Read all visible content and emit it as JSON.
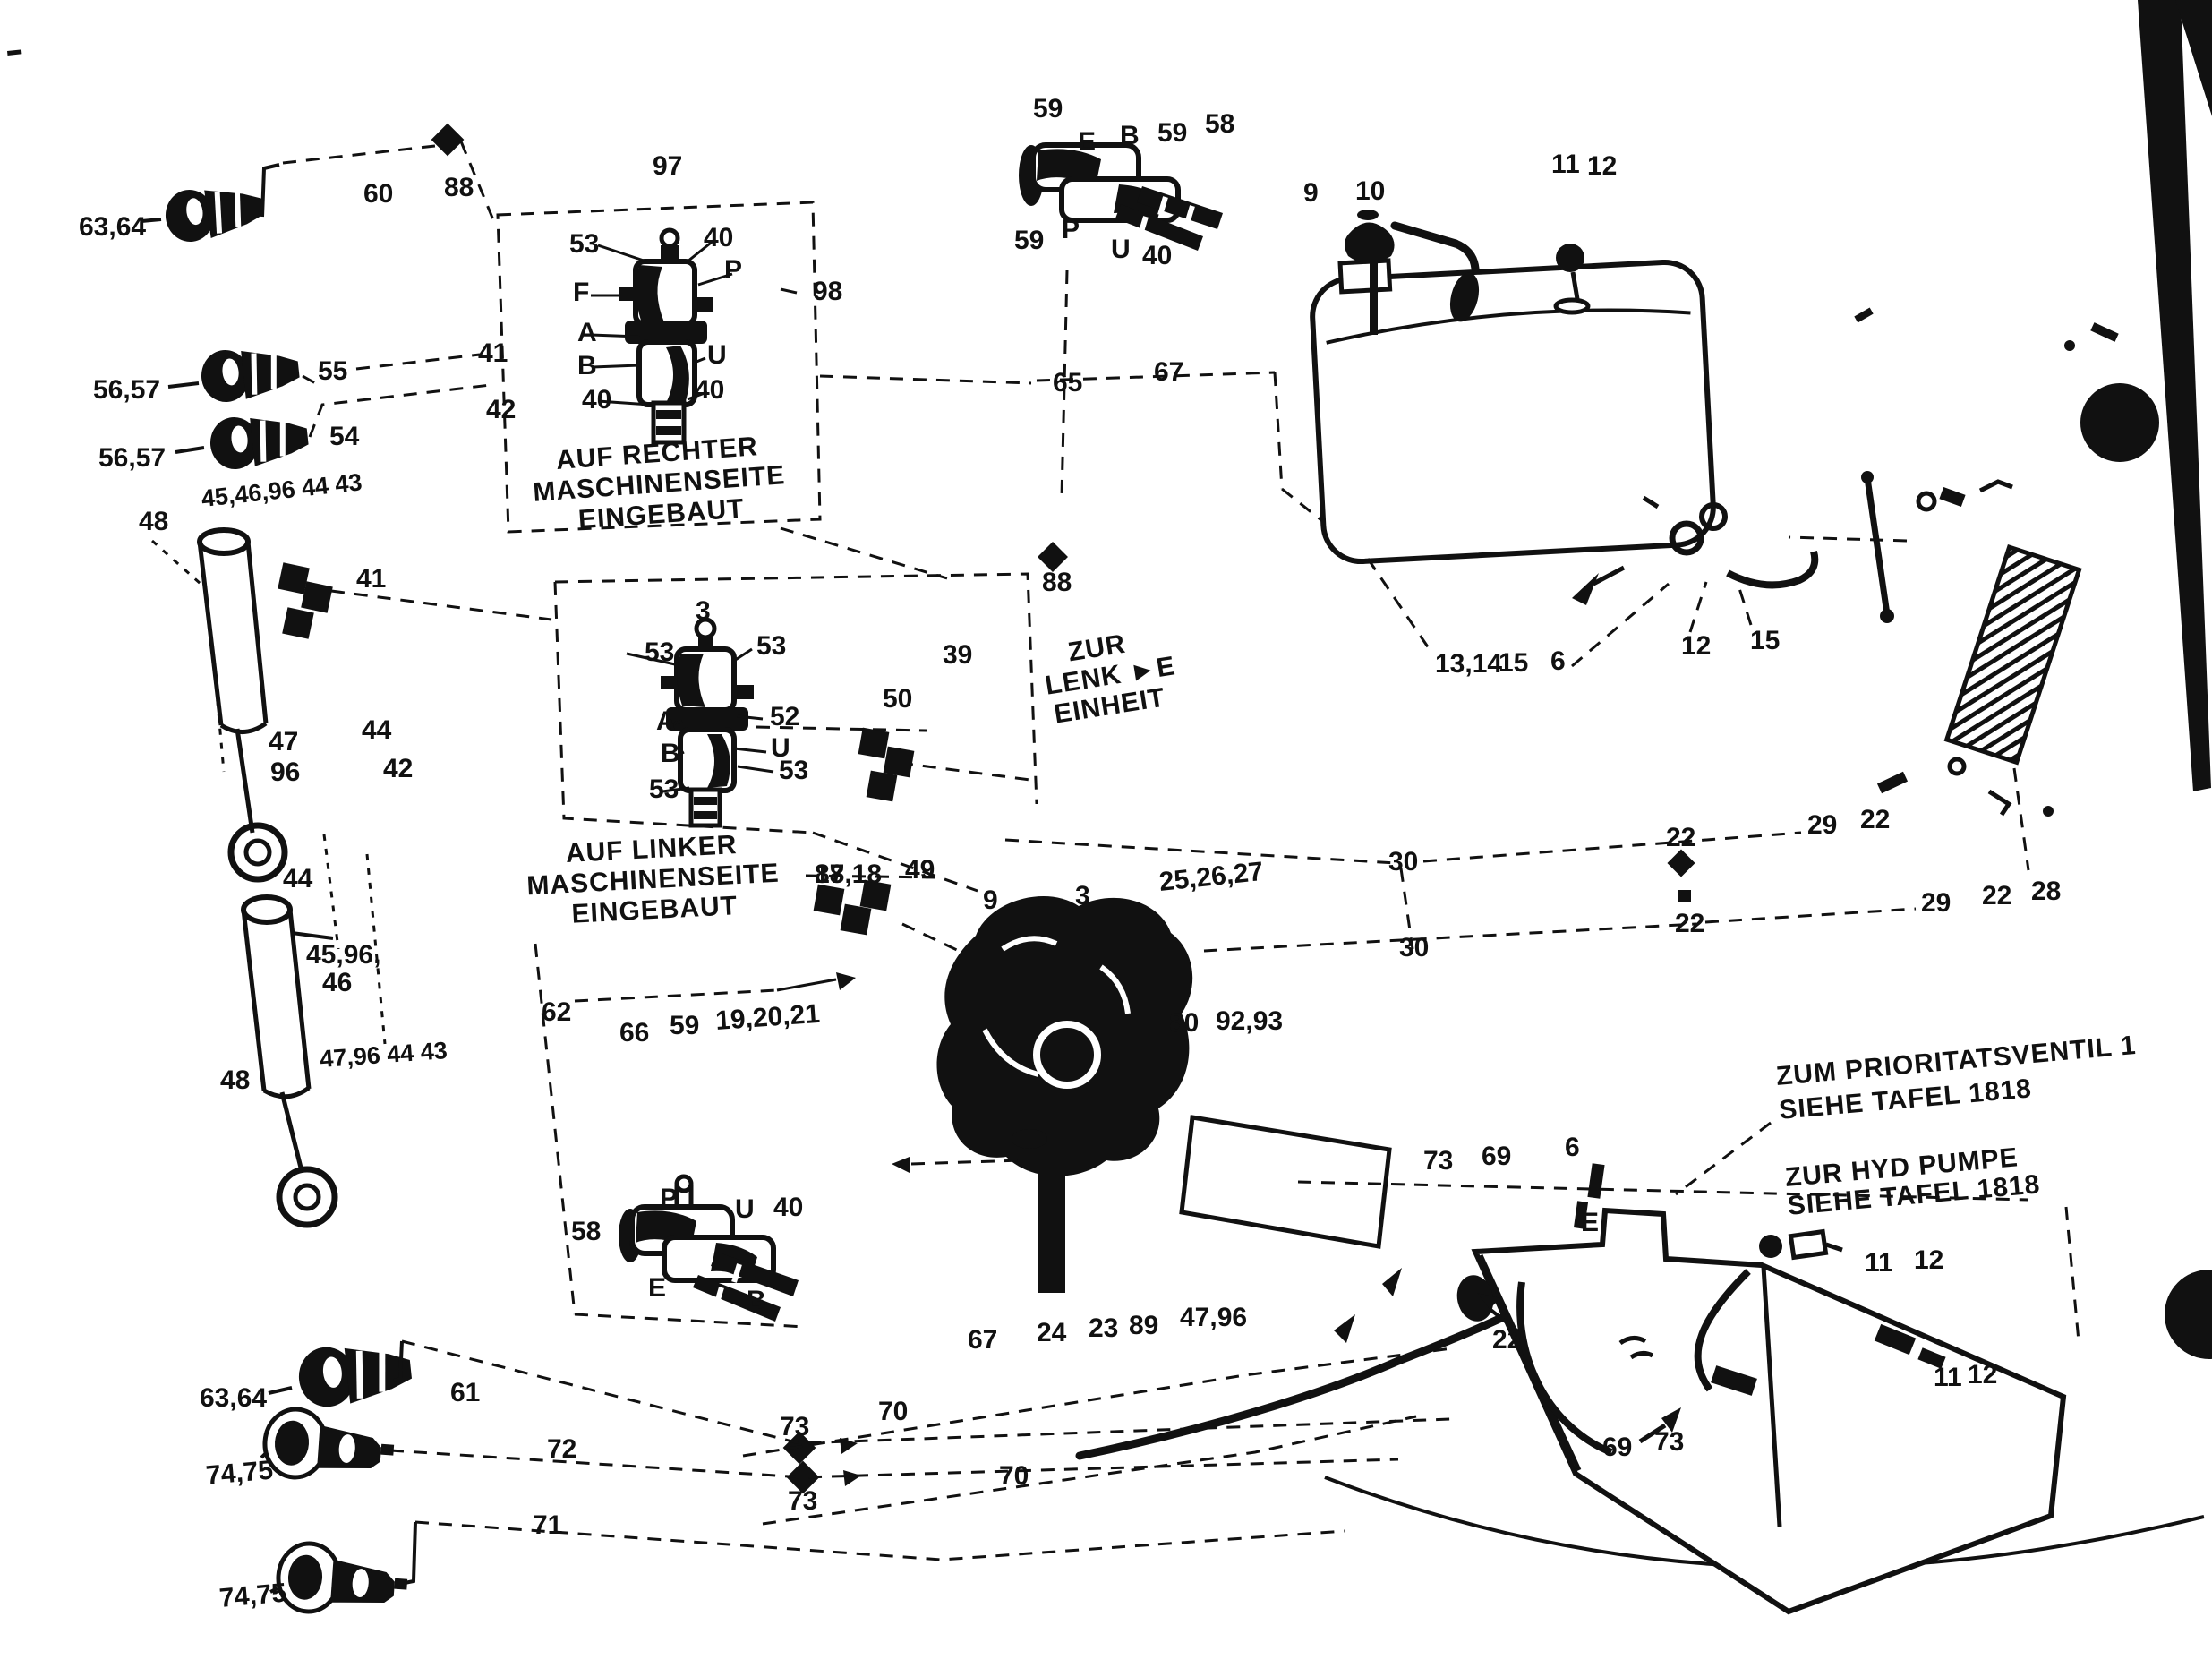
{
  "notes": {
    "right_installed": [
      "AUF RECHTER",
      "MASCHINENSEITE",
      "EINGEBAUT"
    ],
    "left_installed": [
      "AUF LINKER",
      "MASCHINENSEITE",
      "EINGEBAUT"
    ],
    "steering": [
      "ZUR",
      "LENK ►E",
      "EINHEIT"
    ],
    "priority_valve": [
      "ZUM PRIORITATSVENTIL 1",
      "SIEHE TAFEL 1818"
    ],
    "hyd_pump": [
      "ZUR HYD PUMPE",
      "SIEHE TAFEL 1818"
    ]
  },
  "colors": {
    "ink": "#111111",
    "paper": "#ffffff"
  },
  "labels": [
    "63,64",
    "60",
    "88",
    "97",
    "53",
    "40",
    "F",
    "P",
    "98",
    "A",
    "B",
    "U",
    "40",
    "40",
    "59",
    "E",
    "B",
    "59",
    "58",
    "59",
    "P",
    "U",
    "40",
    "65",
    "67",
    "9",
    "10",
    "11",
    "12",
    "13,14",
    "15",
    "6",
    "12",
    "15",
    "56,57",
    "55",
    "41",
    "56,57",
    "54",
    "42",
    "48",
    "45,46,96 44 43",
    "41",
    "44",
    "42",
    "47",
    "96",
    "44",
    "45,96,",
    "46",
    "48",
    "47,96 44 43",
    "3",
    "53",
    "53",
    "A",
    "B",
    "53",
    "52",
    "U",
    "53",
    "39",
    "50",
    "88",
    "17,18",
    "49",
    "9",
    "3",
    "25,26,27",
    "80",
    "92,93",
    "30",
    "30",
    "22",
    "22",
    "29",
    "22",
    "29",
    "22",
    "28",
    "62",
    "66",
    "59",
    "19,20,21",
    "58",
    "P",
    "U",
    "40",
    "E",
    "B",
    "67",
    "24",
    "23",
    "89",
    "47,96",
    "70",
    "70",
    "73",
    "73",
    "63,64",
    "61",
    "74,75",
    "72",
    "71",
    "74,75",
    "73",
    "69",
    "6",
    "E",
    "22",
    "69",
    "73",
    "11",
    "12",
    "11",
    "12"
  ]
}
